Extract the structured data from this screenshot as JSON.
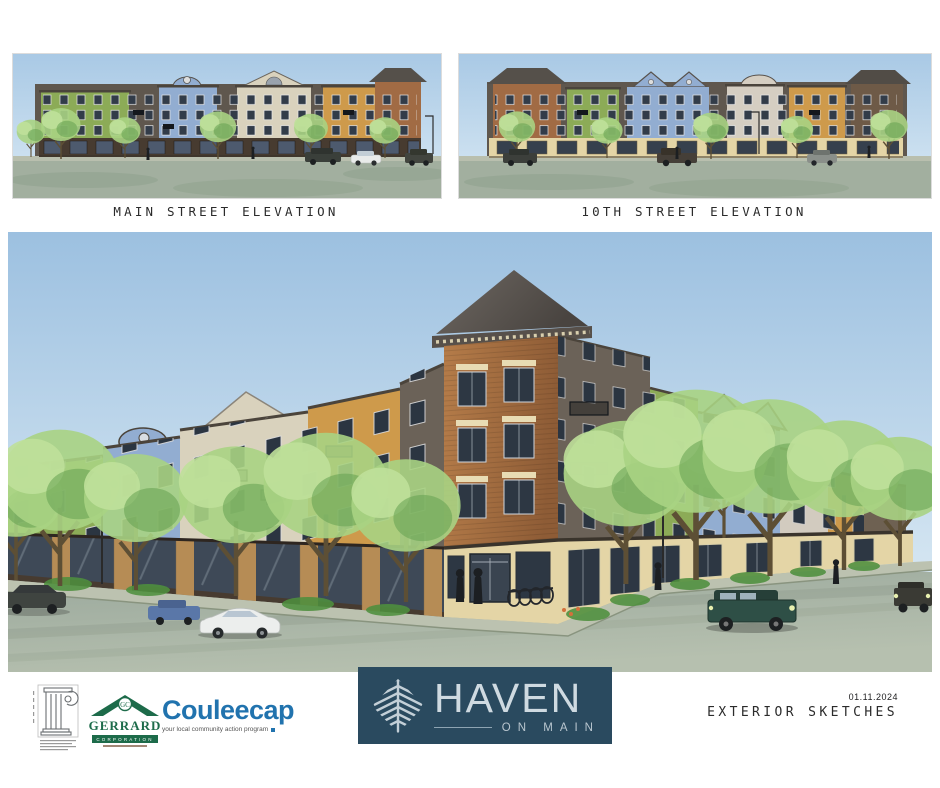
{
  "header": {
    "elevations": [
      {
        "caption": "MAIN STREET ELEVATION"
      },
      {
        "caption": "10TH STREET ELEVATION"
      }
    ]
  },
  "footer": {
    "gerrard": {
      "monogram": "GC",
      "name": "GERRARD",
      "subtitle": "CORPORATION"
    },
    "couleecap": {
      "name": "Couleecap",
      "tagline": "your local community action program"
    },
    "haven": {
      "name": "HAVEN",
      "subtitle": "ON MAIN"
    },
    "date": "01.11.2024",
    "sheet_title": "EXTERIOR SKETCHES"
  },
  "palette": {
    "sky_top": "#9cc0e0",
    "sky_bottom": "#d8e8f3",
    "street": "#a2af9f",
    "sidewalk": "#bcc2b0",
    "facade_green": "#8cab57",
    "facade_blue": "#92add1",
    "facade_cream": "#d9d2bd",
    "facade_tan": "#d2cbbf",
    "facade_orange": "#ce9a4b",
    "facade_brick": "#a16b44",
    "facade_dark": "#6b6258",
    "roof_dark": "#54504b",
    "storefront_dark": "#473b30",
    "stone": "#e4d5a6",
    "glass_dark": "#2d3743",
    "tree_light": "#a9d383",
    "tree_dark": "#64a151",
    "shrub": "#4e8f3e",
    "haven_bg": "#2a4a5f",
    "haven_fg": "#cfdae1",
    "gerrard_green": "#1d6b4a",
    "couleecap_blue": "#2173ae"
  }
}
